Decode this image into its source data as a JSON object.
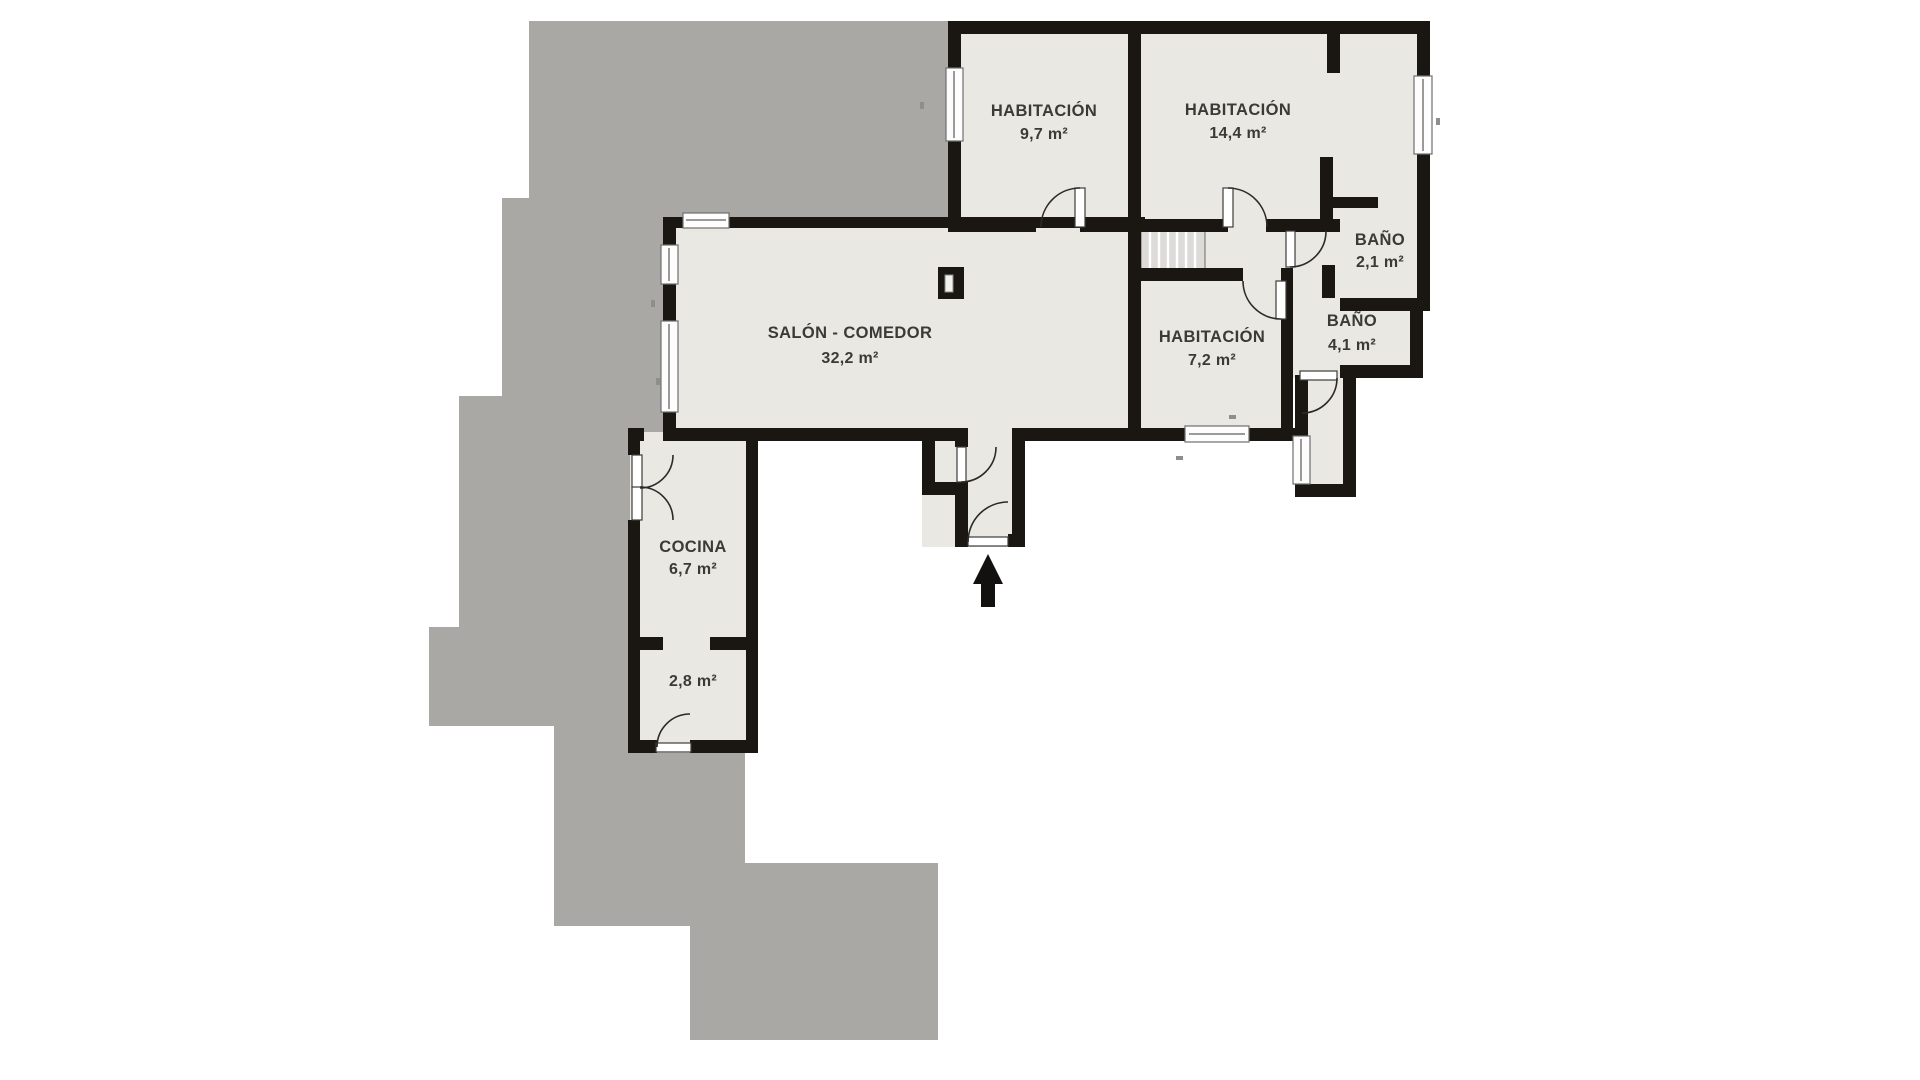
{
  "plan": {
    "type": "floor-plan",
    "language": "es",
    "rooms": [
      {
        "id": "habitacion-1",
        "name": "HABITACIÓN",
        "area": "9,7 m²"
      },
      {
        "id": "habitacion-2",
        "name": "HABITACIÓN",
        "area": "14,4 m²"
      },
      {
        "id": "bano-1",
        "name": "BAÑO",
        "area": "2,1 m²"
      },
      {
        "id": "bano-2",
        "name": "BAÑO",
        "area": "4,1 m²"
      },
      {
        "id": "habitacion-3",
        "name": "HABITACIÓN",
        "area": "7,2 m²"
      },
      {
        "id": "salon",
        "name": "SALÓN - COMEDOR",
        "area": "32,2 m²"
      },
      {
        "id": "cocina",
        "name": "COCINA",
        "area": "6,7 m²"
      },
      {
        "id": "trastero",
        "name": "",
        "area": "2,8 m²"
      }
    ],
    "features": [
      "stairs",
      "entrance-arrow",
      "terrace",
      "windows",
      "doors",
      "column"
    ]
  },
  "palette": {
    "background": "#ffffff",
    "terrace_gray": "#a9a8a5",
    "room_floor": "#eae8e3",
    "wall_black": "#1a1713",
    "window_white": "#fdfdfd",
    "stairs_gray": "#dcdbd8",
    "label_text": "#3b3a37"
  }
}
